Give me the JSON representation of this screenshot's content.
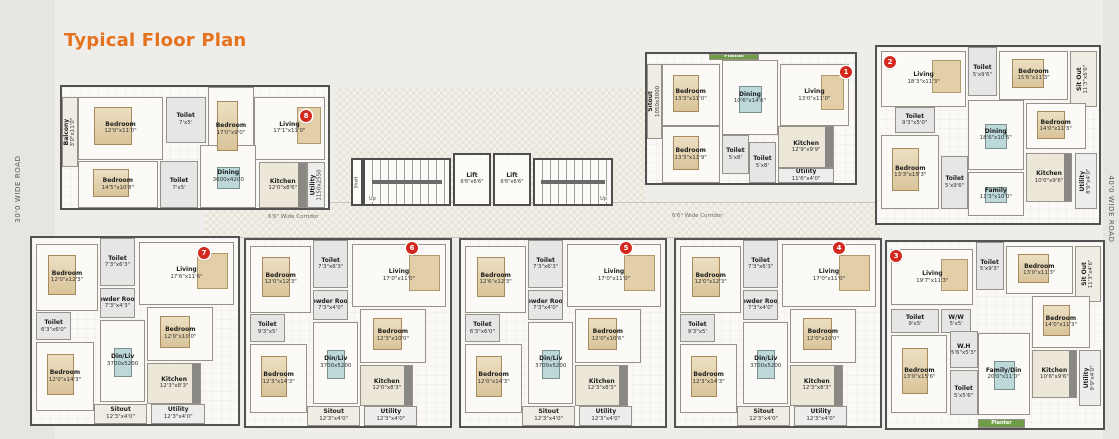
{
  "title": "Typical Floor Plan",
  "roads": {
    "left": "30'0 WIDE ROAD",
    "right": "40'0 WIDE ROAD"
  },
  "corridor_labels": [
    "6'6\" Wide Corridor",
    "6'6\" Wide Corridor"
  ],
  "core": {
    "shaft_label": "Shaft",
    "stair_up_labels": [
      "Up",
      "Up"
    ],
    "lifts": [
      {
        "name": "Lift",
        "size": "6'6\"x6'6\""
      },
      {
        "name": "Lift",
        "size": "6'6\"x6'6\""
      }
    ]
  },
  "colors": {
    "accent": "#e4721f",
    "badge": "#d2281e",
    "planter": "#6f9c46",
    "walls": "#525252"
  },
  "units": [
    {
      "number": "1",
      "rooms": [
        {
          "name": "Planter",
          "size": ""
        },
        {
          "name": "Sitout",
          "size": "1050x3000"
        },
        {
          "name": "Bedroom",
          "size": "13'3\"x11'0\""
        },
        {
          "name": "Dining",
          "size": "10'6\"x14'6\""
        },
        {
          "name": "Living",
          "size": "13'0\"x11'0\""
        },
        {
          "name": "Bedroom",
          "size": "13'3\"x11'9\""
        },
        {
          "name": "Toilet",
          "size": "5'x8'"
        },
        {
          "name": "Toilet",
          "size": "5'x8'"
        },
        {
          "name": "Kitchen",
          "size": "12'9\"x9'9\""
        },
        {
          "name": "Utility",
          "size": "11'6\"x4'0\""
        }
      ]
    },
    {
      "number": "2",
      "rooms": [
        {
          "name": "Living",
          "size": "18'3\"x11'3\""
        },
        {
          "name": "Toilet",
          "size": "5'x9'6\""
        },
        {
          "name": "Bedroom",
          "size": "15'6\"x11'3\""
        },
        {
          "name": "Sit Out",
          "size": "11'3\"x6'6\""
        },
        {
          "name": "Toilet",
          "size": "9'3\"x5'0\""
        },
        {
          "name": "Dining",
          "size": "18'6\"x10'6\""
        },
        {
          "name": "Bedroom",
          "size": "14'0\"x11'3\""
        },
        {
          "name": "Bedroom",
          "size": "13'3\"x15'3\""
        },
        {
          "name": "Toilet",
          "size": "5'x9'6\""
        },
        {
          "name": "Family",
          "size": "11'3\"x10'0\""
        },
        {
          "name": "Kitchen",
          "size": "10'0\"x9'6\""
        },
        {
          "name": "Utility",
          "size": "8'9\"x4'0\""
        }
      ]
    },
    {
      "number": "3",
      "rooms": [
        {
          "name": "Living",
          "size": "19'7\"x11'3\""
        },
        {
          "name": "Toilet",
          "size": "5'x9'3\""
        },
        {
          "name": "Bedroom",
          "size": "13'0\"x11'3\""
        },
        {
          "name": "Sit Out",
          "size": "11'3\"x4'6\""
        },
        {
          "name": "Toilet",
          "size": "9'x5'"
        },
        {
          "name": "W/W",
          "size": "5'x5'"
        },
        {
          "name": "Bedroom",
          "size": "13'0\"x15'6\""
        },
        {
          "name": "W.H",
          "size": "5'6\"x5'3\""
        },
        {
          "name": "Toilet",
          "size": "5'x5'6\""
        },
        {
          "name": "Bedroom",
          "size": "14'0\"x11'3\""
        },
        {
          "name": "Family/Din",
          "size": "20'0\"x11'0\""
        },
        {
          "name": "Kitchen",
          "size": "10'6\"x9'6\""
        },
        {
          "name": "Utility",
          "size": "9'9\"x4'0\""
        },
        {
          "name": "Planter",
          "size": ""
        }
      ]
    },
    {
      "number": "4",
      "rooms": [
        {
          "name": "Bedroom",
          "size": "12'0\"x12'3\""
        },
        {
          "name": "Toilet",
          "size": "7'3\"x6'3\""
        },
        {
          "name": "Living",
          "size": "17'0\"x11'0\""
        },
        {
          "name": "Powder Room",
          "size": "7'3\"x4'0\""
        },
        {
          "name": "Toilet",
          "size": "9'3\"x5'"
        },
        {
          "name": "Bedroom",
          "size": "12'0\"x10'0\""
        },
        {
          "name": "Din/Liv",
          "size": "3700x5200"
        },
        {
          "name": "Bedroom",
          "size": "12'3\"x14'3\""
        },
        {
          "name": "Kitchen",
          "size": "12'3\"x8'3\""
        },
        {
          "name": "Sitout",
          "size": "12'3\"x4'0\""
        },
        {
          "name": "Utility",
          "size": "12'3\"x4'0\""
        }
      ]
    },
    {
      "number": "5",
      "rooms": [
        {
          "name": "Bedroom",
          "size": "12'6\"x12'3\""
        },
        {
          "name": "Toilet",
          "size": "7'3\"x6'3\""
        },
        {
          "name": "Living",
          "size": "17'0\"x11'0\""
        },
        {
          "name": "Powder Room",
          "size": "7'3\"x4'0\""
        },
        {
          "name": "Toilet",
          "size": "6'3\"x6'0\""
        },
        {
          "name": "Bedroom",
          "size": "12'0\"x10'6\""
        },
        {
          "name": "Din/Liv",
          "size": "3700x5200"
        },
        {
          "name": "Bedroom",
          "size": "12'0\"x14'3\""
        },
        {
          "name": "Kitchen",
          "size": "12'3\"x8'3\""
        },
        {
          "name": "Sitout",
          "size": "12'3\"x4'0\""
        },
        {
          "name": "Utility",
          "size": "12'3\"x4'0\""
        }
      ]
    },
    {
      "number": "6",
      "rooms": [
        {
          "name": "Bedroom",
          "size": "12'0\"x12'3\""
        },
        {
          "name": "Toilet",
          "size": "7'3\"x6'3\""
        },
        {
          "name": "Living",
          "size": "17'0\"x11'0\""
        },
        {
          "name": "Powder Room",
          "size": "7'3\"x4'0\""
        },
        {
          "name": "Toilet",
          "size": "9'3\"x5'"
        },
        {
          "name": "Bedroom",
          "size": "12'3\"x10'0\""
        },
        {
          "name": "Din/Liv",
          "size": "3700x5200"
        },
        {
          "name": "Bedroom",
          "size": "12'3\"x14'3\""
        },
        {
          "name": "Kitchen",
          "size": "12'0\"x8'3\""
        },
        {
          "name": "Sitout",
          "size": "12'3\"x4'0\""
        },
        {
          "name": "Utility",
          "size": "12'3\"x4'0\""
        }
      ]
    },
    {
      "number": "7",
      "rooms": [
        {
          "name": "Bedroom",
          "size": "12'0\"x12'3\""
        },
        {
          "name": "Toilet",
          "size": "7'3\"x6'3\""
        },
        {
          "name": "Living",
          "size": "17'6\"x11'6\""
        },
        {
          "name": "Powder Room",
          "size": "7'3\"x4'3\""
        },
        {
          "name": "Toilet",
          "size": "6'3\"x6'0\""
        },
        {
          "name": "Bedroom",
          "size": "12'0\"x10'0\""
        },
        {
          "name": "Din/Liv",
          "size": "3700x5200"
        },
        {
          "name": "Bedroom",
          "size": "12'0\"x14'3\""
        },
        {
          "name": "Kitchen",
          "size": "12'3\"x8'3\""
        },
        {
          "name": "Sitout",
          "size": "12'3\"x4'0\""
        },
        {
          "name": "Utility",
          "size": "12'3\"x4'0\""
        }
      ]
    },
    {
      "number": "8",
      "rooms": [
        {
          "name": "Balcony",
          "size": "3'0\"x11'0\""
        },
        {
          "name": "Bedroom",
          "size": "12'0\"x11'0\""
        },
        {
          "name": "Toilet",
          "size": "7'x5'"
        },
        {
          "name": "Bedroom",
          "size": "17'0\"x9'0\""
        },
        {
          "name": "Living",
          "size": "17'1\"x11'0\""
        },
        {
          "name": "Dining",
          "size": "3600x4200"
        },
        {
          "name": "Bedroom",
          "size": "14'5\"x10'8\""
        },
        {
          "name": "Toilet",
          "size": "7'x5'"
        },
        {
          "name": "Kitchen",
          "size": "12'0\"x8'6\""
        },
        {
          "name": "Utility",
          "size": "1150x2550"
        }
      ]
    }
  ]
}
